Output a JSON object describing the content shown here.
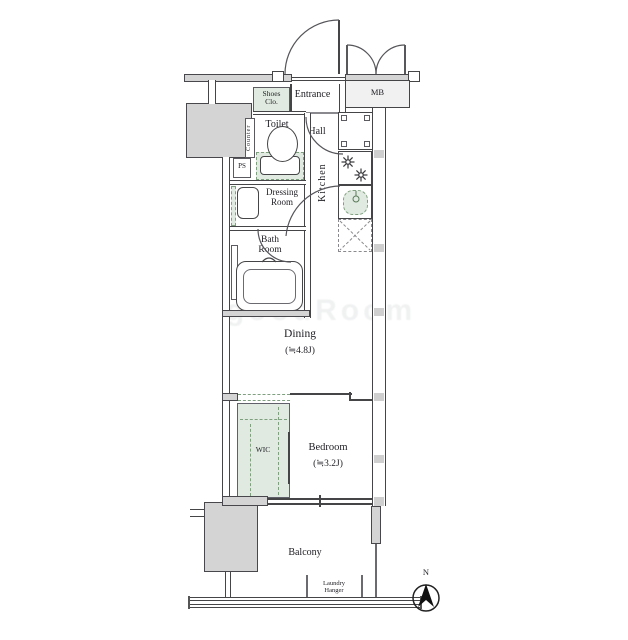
{
  "labels": {
    "entrance": "Entrance",
    "shoes_1": "Shoes",
    "shoes_2": "Clo.",
    "mb": "MB",
    "toilet": "Toilet",
    "hall": "Hall",
    "counter": "Counter",
    "ps": "PS",
    "dressing_1": "Dressing",
    "dressing_2": "Room",
    "kitchen": "Kitchen",
    "bath_1": "Bath",
    "bath_2": "Room",
    "dining": "Dining",
    "dining_size": "(≒4.8J)",
    "wic": "WIC",
    "bedroom": "Bedroom",
    "bedroom_size": "(≒3.2J)",
    "balcony": "Balcony",
    "laundry_1": "Laundry",
    "laundry_2": "Hanger",
    "north": "N",
    "watermark": "goodRoom"
  },
  "colors": {
    "wall_line": "#454548",
    "structural_fill": "#d4d4d4",
    "closet_green_fill": "#e0eae0",
    "closet_green_line": "#7fa07f",
    "label_text": "#1e1e24"
  }
}
